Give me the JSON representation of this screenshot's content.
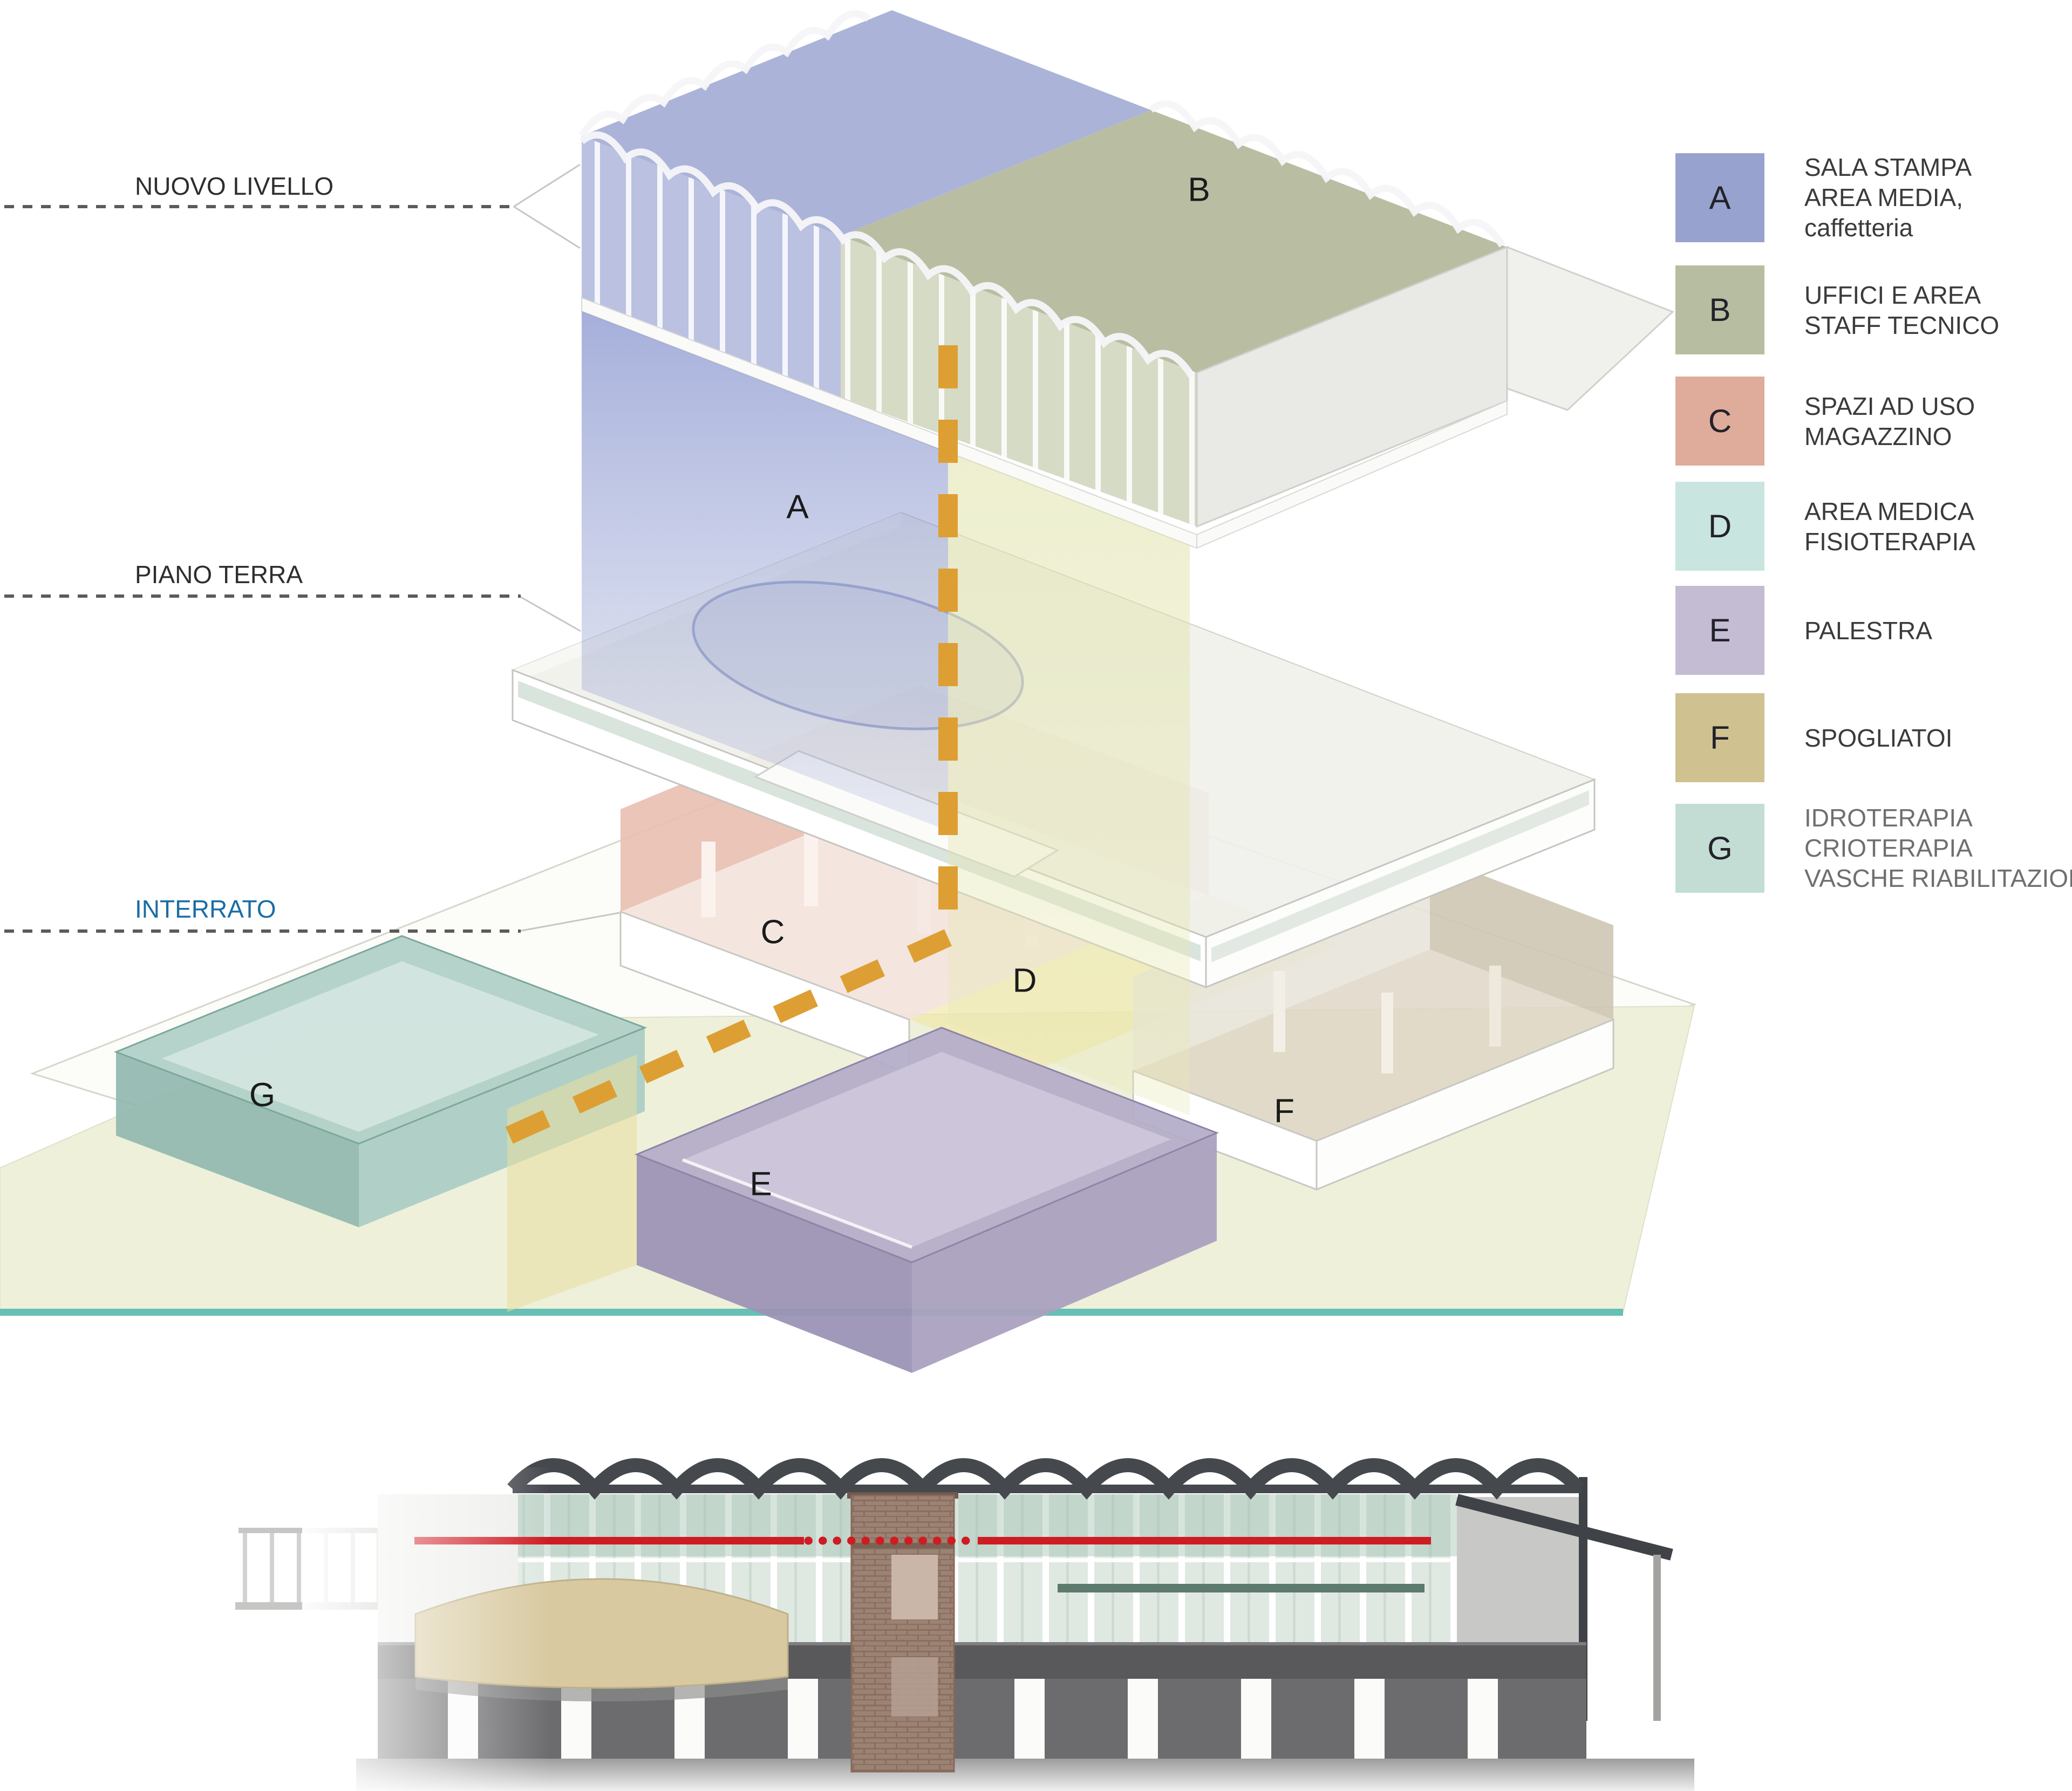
{
  "levels": [
    {
      "id": "nuovo-livello",
      "label": "NUOVO LIVELLO",
      "text_color": "#2e2e2e"
    },
    {
      "id": "piano-terra",
      "label": "PIANO TERRA",
      "text_color": "#2e2e2e"
    },
    {
      "id": "interrato",
      "label": "INTERRATO",
      "text_color": "#1b6da5"
    }
  ],
  "zones": [
    {
      "letter": "A",
      "color": "#97a2ce"
    },
    {
      "letter": "B",
      "color": "#b7bda0"
    },
    {
      "letter": "C",
      "color": "#dfab9a"
    },
    {
      "letter": "D",
      "color": "#c9e5df"
    },
    {
      "letter": "E",
      "color": "#c4bcd2"
    },
    {
      "letter": "F",
      "color": "#cfc290"
    },
    {
      "letter": "G",
      "color": "#c3ddd4"
    }
  ],
  "legend": {
    "items": [
      {
        "letter": "A",
        "color": "#97a2ce",
        "lines": [
          "SALA STAMPA",
          "AREA MEDIA,",
          "caffetteria"
        ]
      },
      {
        "letter": "B",
        "color": "#b7bda0",
        "lines": [
          "UFFICI E AREA",
          "STAFF TECNICO"
        ]
      },
      {
        "letter": "C",
        "color": "#dfab9a",
        "lines": [
          "SPAZI AD USO",
          "MAGAZZINO"
        ]
      },
      {
        "letter": "D",
        "color": "#c9e5df",
        "lines": [
          "AREA MEDICA",
          "FISIOTERAPIA"
        ]
      },
      {
        "letter": "E",
        "color": "#c4bcd2",
        "lines": [
          "PALESTRA"
        ]
      },
      {
        "letter": "F",
        "color": "#cfc290",
        "lines": [
          "SPOGLIATOI"
        ]
      },
      {
        "letter": "G",
        "color": "#c3ddd4",
        "lines": [
          "IDROTERAPIA",
          "CRIOTERAPIA",
          "VASCHE RIABILITAZIONE"
        ]
      }
    ]
  },
  "annotation_colors": {
    "exploded_trace_dashed": "#dd9f33",
    "section_cut_line": "#cf1b22",
    "ground_baseline": "#66c0b5",
    "interrato_label": "#1b6da5",
    "level_dash_line": "#5b5b5b"
  }
}
